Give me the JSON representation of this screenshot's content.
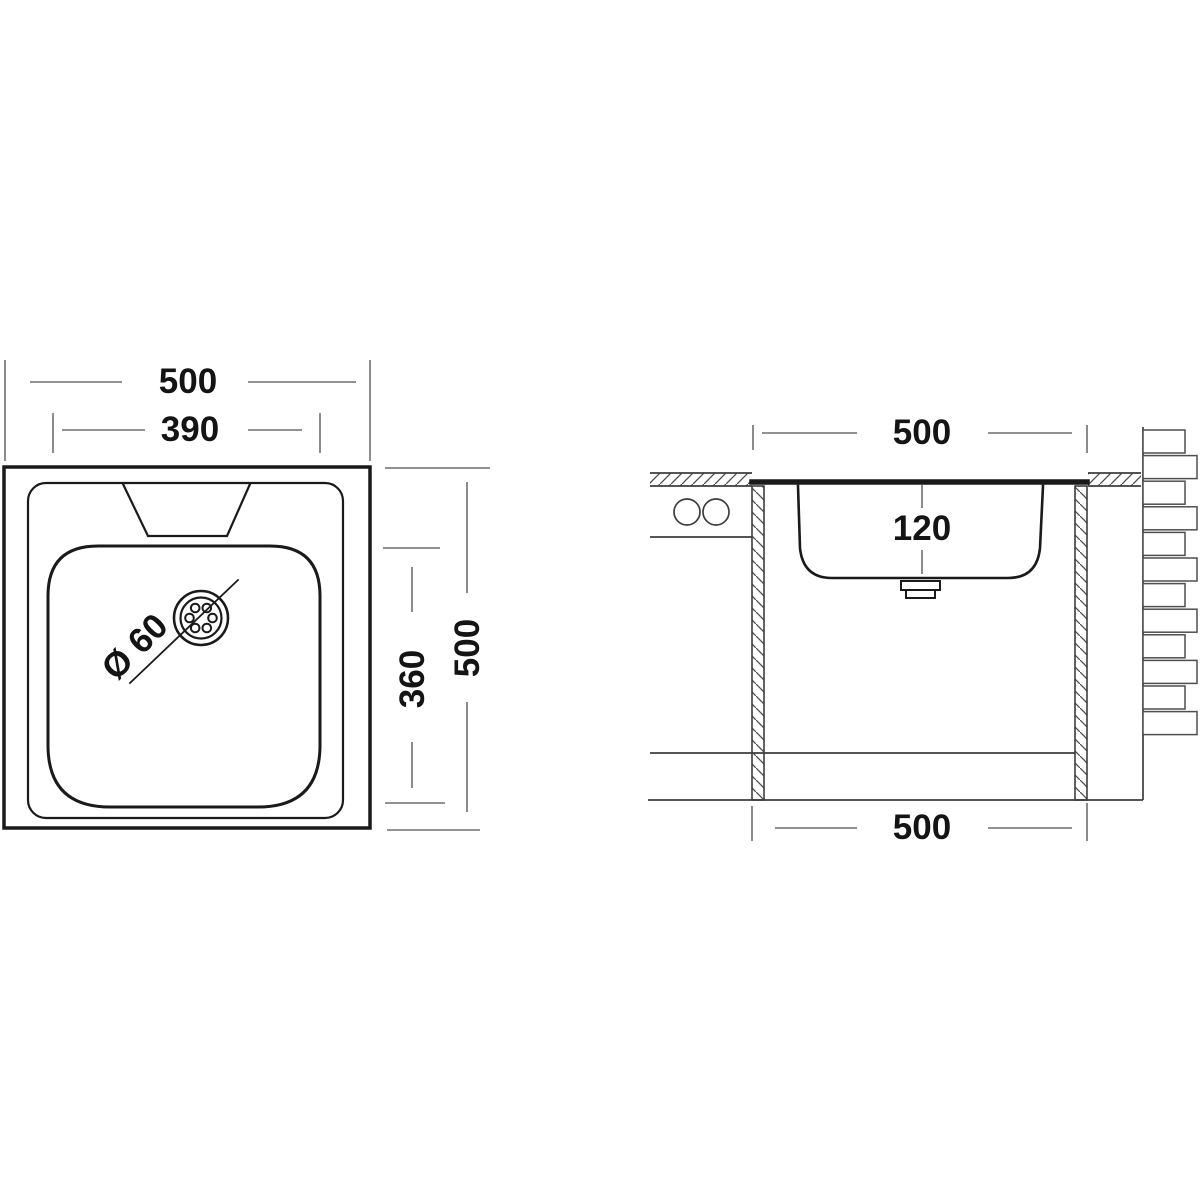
{
  "drawing": {
    "title": "sink-technical-drawing",
    "colors": {
      "background": "#ffffff",
      "object_line": "#1a1a1a",
      "dimension_line": "#6f6f6f",
      "structure_line": "#3d3d3d",
      "text": "#141414"
    },
    "top_view": {
      "overall_width_label": "500",
      "bowl_width_label": "390",
      "overall_height_label": "500",
      "bowl_height_label": "360",
      "drain_diameter_label": "Ø 60"
    },
    "section_view": {
      "top_width_label": "500",
      "bowl_depth_label": "120",
      "bottom_width_label": "500"
    }
  },
  "chart_data": {
    "type": "table",
    "title": "Kitchen sink dimensions (mm)",
    "categories": [
      "overall width",
      "overall depth",
      "bowl width",
      "bowl depth",
      "bowl height",
      "drain diameter"
    ],
    "values": [
      500,
      500,
      390,
      360,
      120,
      60
    ]
  }
}
